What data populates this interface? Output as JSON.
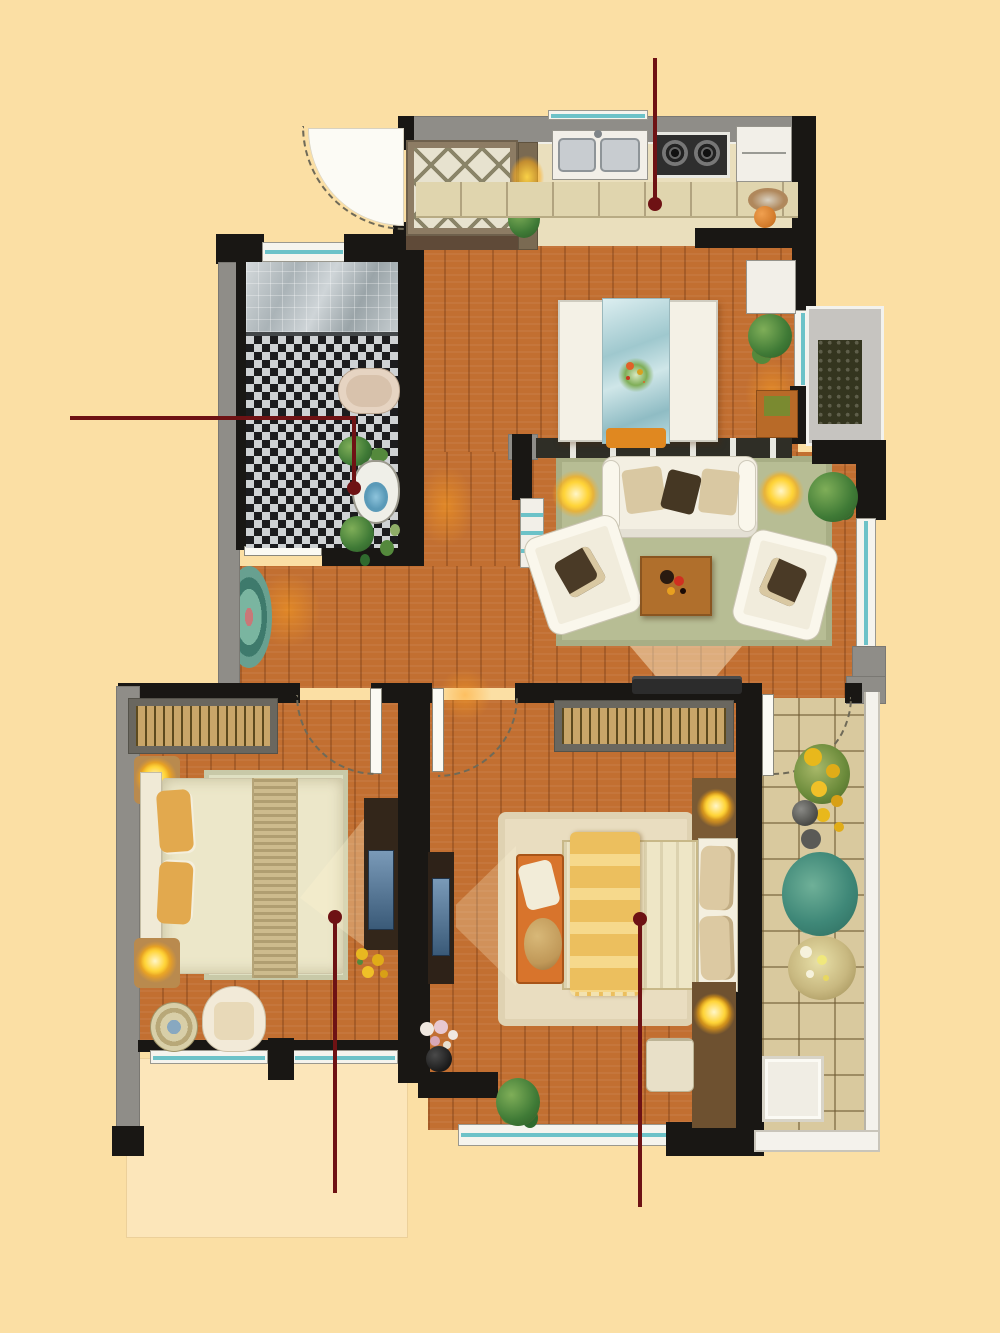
{
  "scene": {
    "kind": "apartment floor plan rendering",
    "canvas_width": 1000,
    "canvas_height": 1333
  },
  "palette": {
    "background": "#fbdfa4",
    "wall_dark": "#191714",
    "wall_gray": "#8f8d88",
    "wood_floor": "#c26f31",
    "kitchen_floor": "#eadfbd",
    "balcony_tile": "#d9c99e",
    "window_teal": "#6cc2c8",
    "rug_green": "#b7bd94",
    "rug_cream": "#e8dcc2",
    "lamp_glow": "#ffd438",
    "annotation_red": "#6e1214",
    "shower_glass": "#b7bfc3",
    "mosaic_dark": "#1c1c1e",
    "mosaic_light": "#cfd2d4",
    "bed_blanket_yellow": "#ecbf5e",
    "bed_cream": "#ece7c9",
    "bench_orange": "#d8742c"
  },
  "rooms": {
    "entry": {
      "label": "entry door"
    },
    "foyer": {
      "label": "foyer"
    },
    "kitchen": {
      "label": "open kitchen"
    },
    "dining": {
      "label": "dining area"
    },
    "bathroom": {
      "label": "bathroom"
    },
    "hallway": {
      "label": "hallway"
    },
    "living": {
      "label": "living room"
    },
    "bedroom1": {
      "label": "left bedroom"
    },
    "bedroom2": {
      "label": "right bedroom"
    },
    "balcony": {
      "label": "balcony"
    },
    "bay": {
      "label": "bay window ledge"
    }
  },
  "furniture": {
    "kitchen": [
      "double sink",
      "two-burner gas stove",
      "refrigerator",
      "base cabinets",
      "console with lamp"
    ],
    "dining": [
      "dining table with glass runner",
      "four chairs",
      "flower centerpiece",
      "sideboard",
      "cabinet with plant"
    ],
    "bathroom": [
      "glass shower",
      "mosaic tile floor",
      "vanity counter",
      "toilet with plants"
    ],
    "living": [
      "three-seat sofa",
      "two armchairs",
      "coffee table",
      "green rug",
      "two floor lamps",
      "potted plant",
      "tv on wall",
      "window bench"
    ],
    "bedroom1": [
      "wardrobe with hangers",
      "double bed with runner",
      "two nightstand lamps",
      "tv cabinet",
      "armchair",
      "round mat",
      "flowers"
    ],
    "bedroom2": [
      "wardrobe with hangers",
      "double bed with yellow striped blanket",
      "foot bench",
      "fluffy rug",
      "two nightstand lamps",
      "tv cabinet",
      "dresser stools",
      "vase of flowers",
      "potted plant"
    ],
    "balcony": [
      "tile floor",
      "sunflowers",
      "green plants",
      "flower pots",
      "white floor mat"
    ],
    "hallway": [
      "oval rug"
    ]
  },
  "annotations": {
    "leader_lines": [
      {
        "id": "kitchen-callout",
        "points": [
          [
            655,
            58
          ],
          [
            655,
            204
          ]
        ],
        "dot_at": [
          655,
          204
        ]
      },
      {
        "id": "toilet-callout",
        "points": [
          [
            70,
            418
          ],
          [
            354,
            418
          ],
          [
            354,
            488
          ]
        ],
        "dot_at": [
          354,
          488
        ]
      },
      {
        "id": "bedroom-left-callout",
        "points": [
          [
            335,
            917
          ],
          [
            335,
            1193
          ]
        ],
        "dot_at": [
          335,
          917
        ]
      },
      {
        "id": "bedroom-right-callout",
        "points": [
          [
            640,
            919
          ],
          [
            640,
            1207
          ]
        ],
        "dot_at": [
          640,
          919
        ]
      }
    ]
  }
}
